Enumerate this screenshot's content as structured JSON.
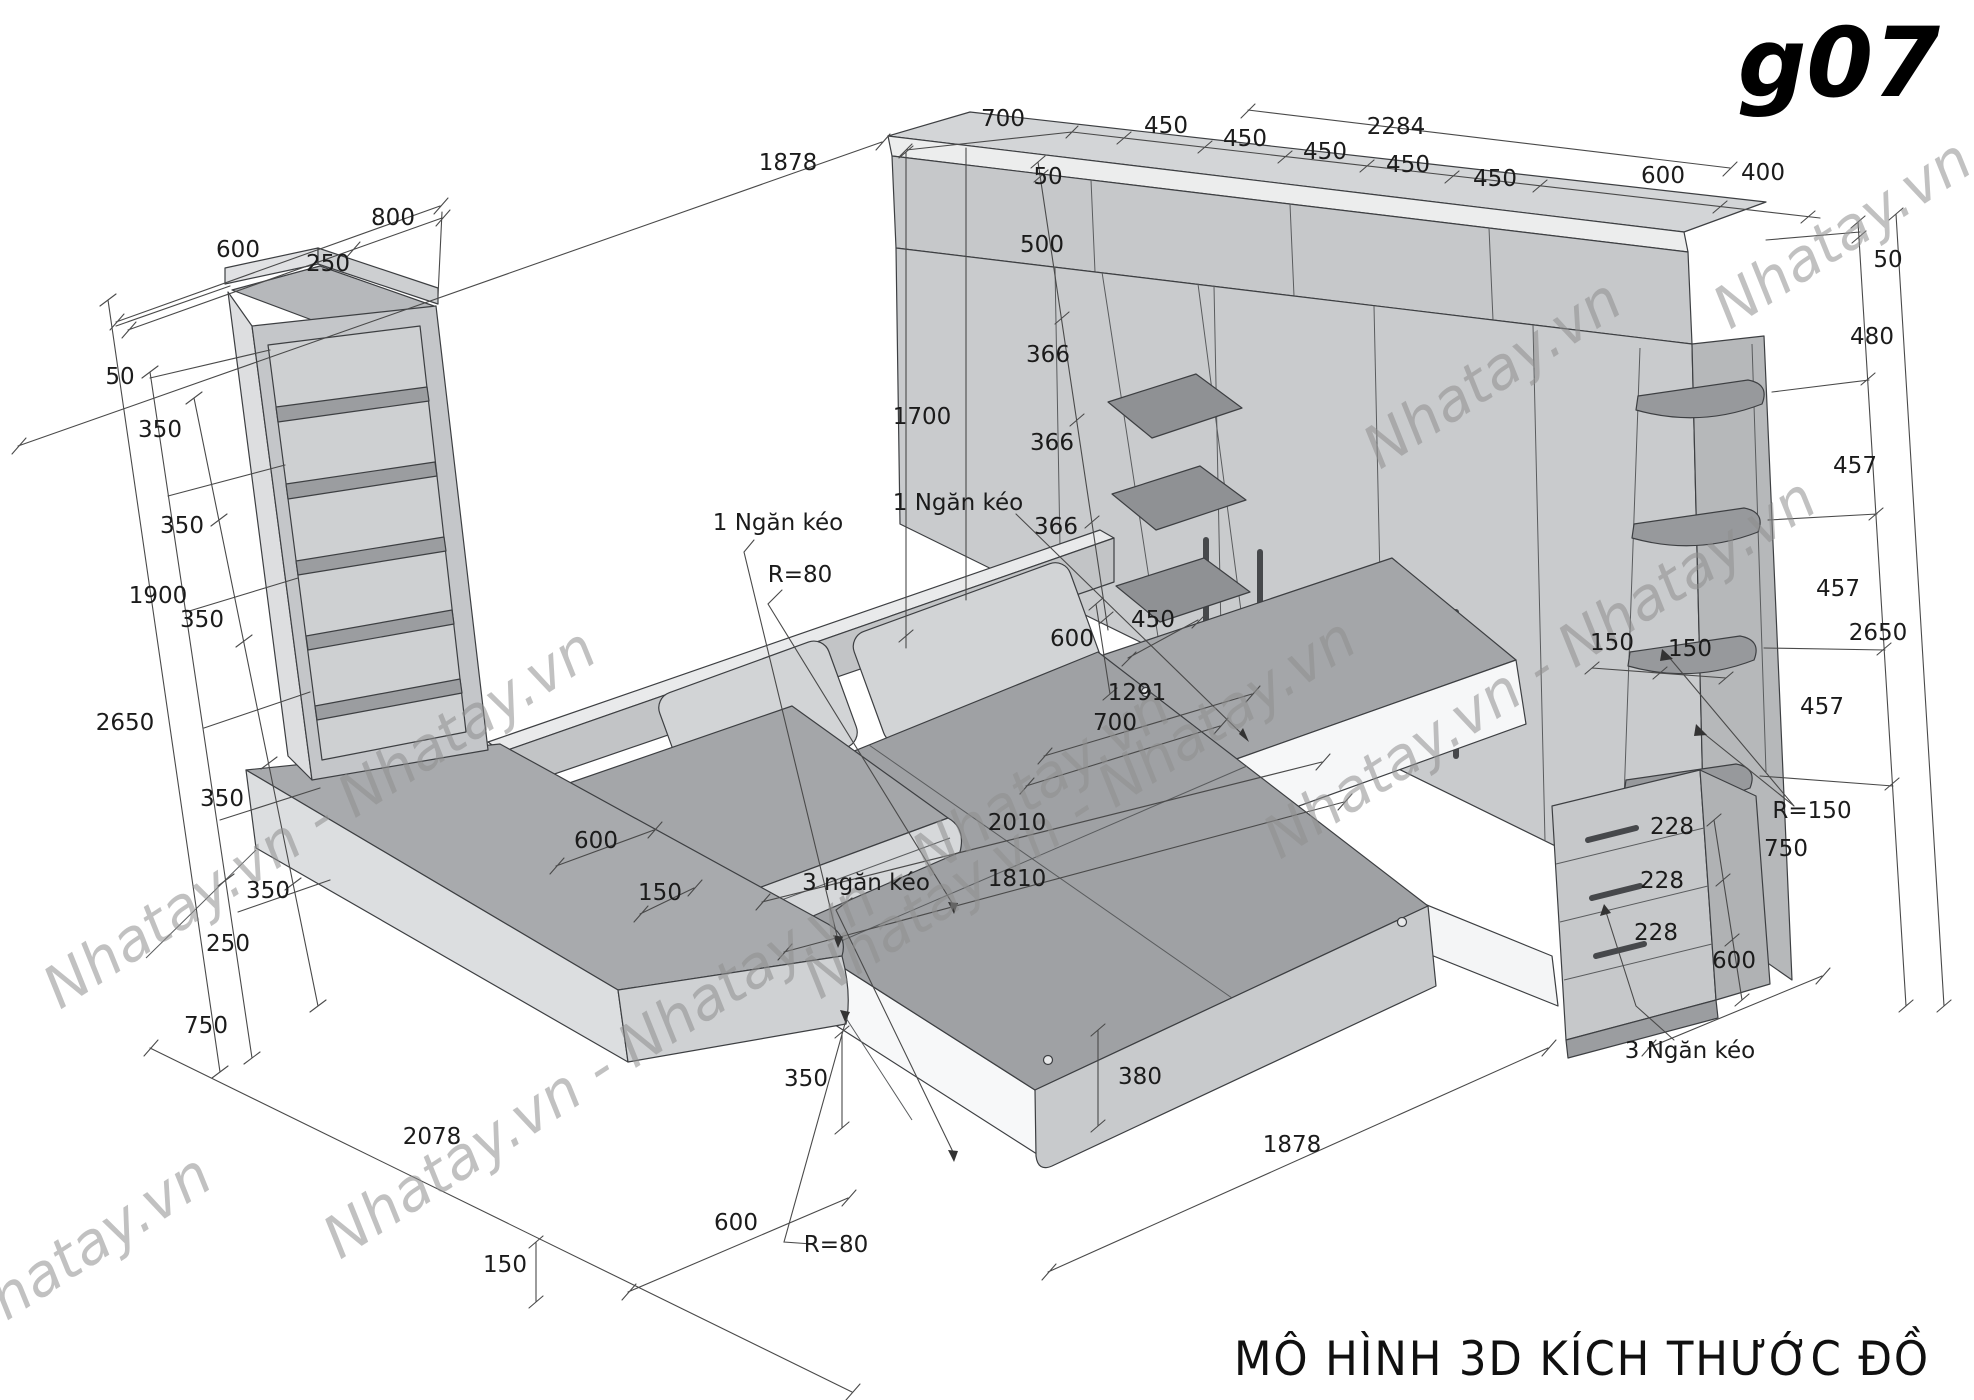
{
  "page": {
    "title": "g07",
    "caption": "MÔ HÌNH 3D KÍCH THƯỚC ĐỒ"
  },
  "watermarks": {
    "single": "Nhatay.vn",
    "pair": "Nhatay.vn - Nhatay.vn",
    "triple": "Nhatay.vn - Nhatay.vn - Nhatay.vn"
  },
  "colors": {
    "background": "#ffffff",
    "outline": "#3d3f42",
    "dimension_line": "#4a4a4a",
    "label_text": "#1b1b1b",
    "watermark": "#8f8f8f",
    "face_light": "#dcdee0",
    "face_mid": "#c6c8ca",
    "face_top": "#a6a8ab",
    "face_white": "#f6f7f8"
  },
  "labels": [
    {
      "text": "800"
    },
    {
      "text": "600"
    },
    {
      "text": "250"
    },
    {
      "text": "50"
    },
    {
      "text": "350"
    },
    {
      "text": "350"
    },
    {
      "text": "1900"
    },
    {
      "text": "350"
    },
    {
      "text": "2650"
    },
    {
      "text": "350"
    },
    {
      "text": "350"
    },
    {
      "text": "250"
    },
    {
      "text": "750"
    },
    {
      "text": "2078"
    },
    {
      "text": "150"
    },
    {
      "text": "1878"
    },
    {
      "text": "1700"
    },
    {
      "text": "1 Ngăn kéo"
    },
    {
      "text": "R=80"
    },
    {
      "text": "1 Ngăn kéo"
    },
    {
      "text": "600"
    },
    {
      "text": "150"
    },
    {
      "text": "3 ngăn kéo"
    },
    {
      "text": "2010"
    },
    {
      "text": "1810"
    },
    {
      "text": "350"
    },
    {
      "text": "380"
    },
    {
      "text": "1878"
    },
    {
      "text": "600"
    },
    {
      "text": "R=80"
    },
    {
      "text": "700"
    },
    {
      "text": "450"
    },
    {
      "text": "2284"
    },
    {
      "text": "450"
    },
    {
      "text": "450"
    },
    {
      "text": "450"
    },
    {
      "text": "450"
    },
    {
      "text": "600"
    },
    {
      "text": "400"
    },
    {
      "text": "50"
    },
    {
      "text": "500"
    },
    {
      "text": "366"
    },
    {
      "text": "366"
    },
    {
      "text": "366"
    },
    {
      "text": "600"
    },
    {
      "text": "450"
    },
    {
      "text": "1291"
    },
    {
      "text": "700"
    },
    {
      "text": "50"
    },
    {
      "text": "480"
    },
    {
      "text": "457"
    },
    {
      "text": "457"
    },
    {
      "text": "2650"
    },
    {
      "text": "457"
    },
    {
      "text": "150"
    },
    {
      "text": "150"
    },
    {
      "text": "R=150"
    },
    {
      "text": "228"
    },
    {
      "text": "228"
    },
    {
      "text": "228"
    },
    {
      "text": "750"
    },
    {
      "text": "600"
    },
    {
      "text": "3 Ngăn kéo"
    }
  ]
}
